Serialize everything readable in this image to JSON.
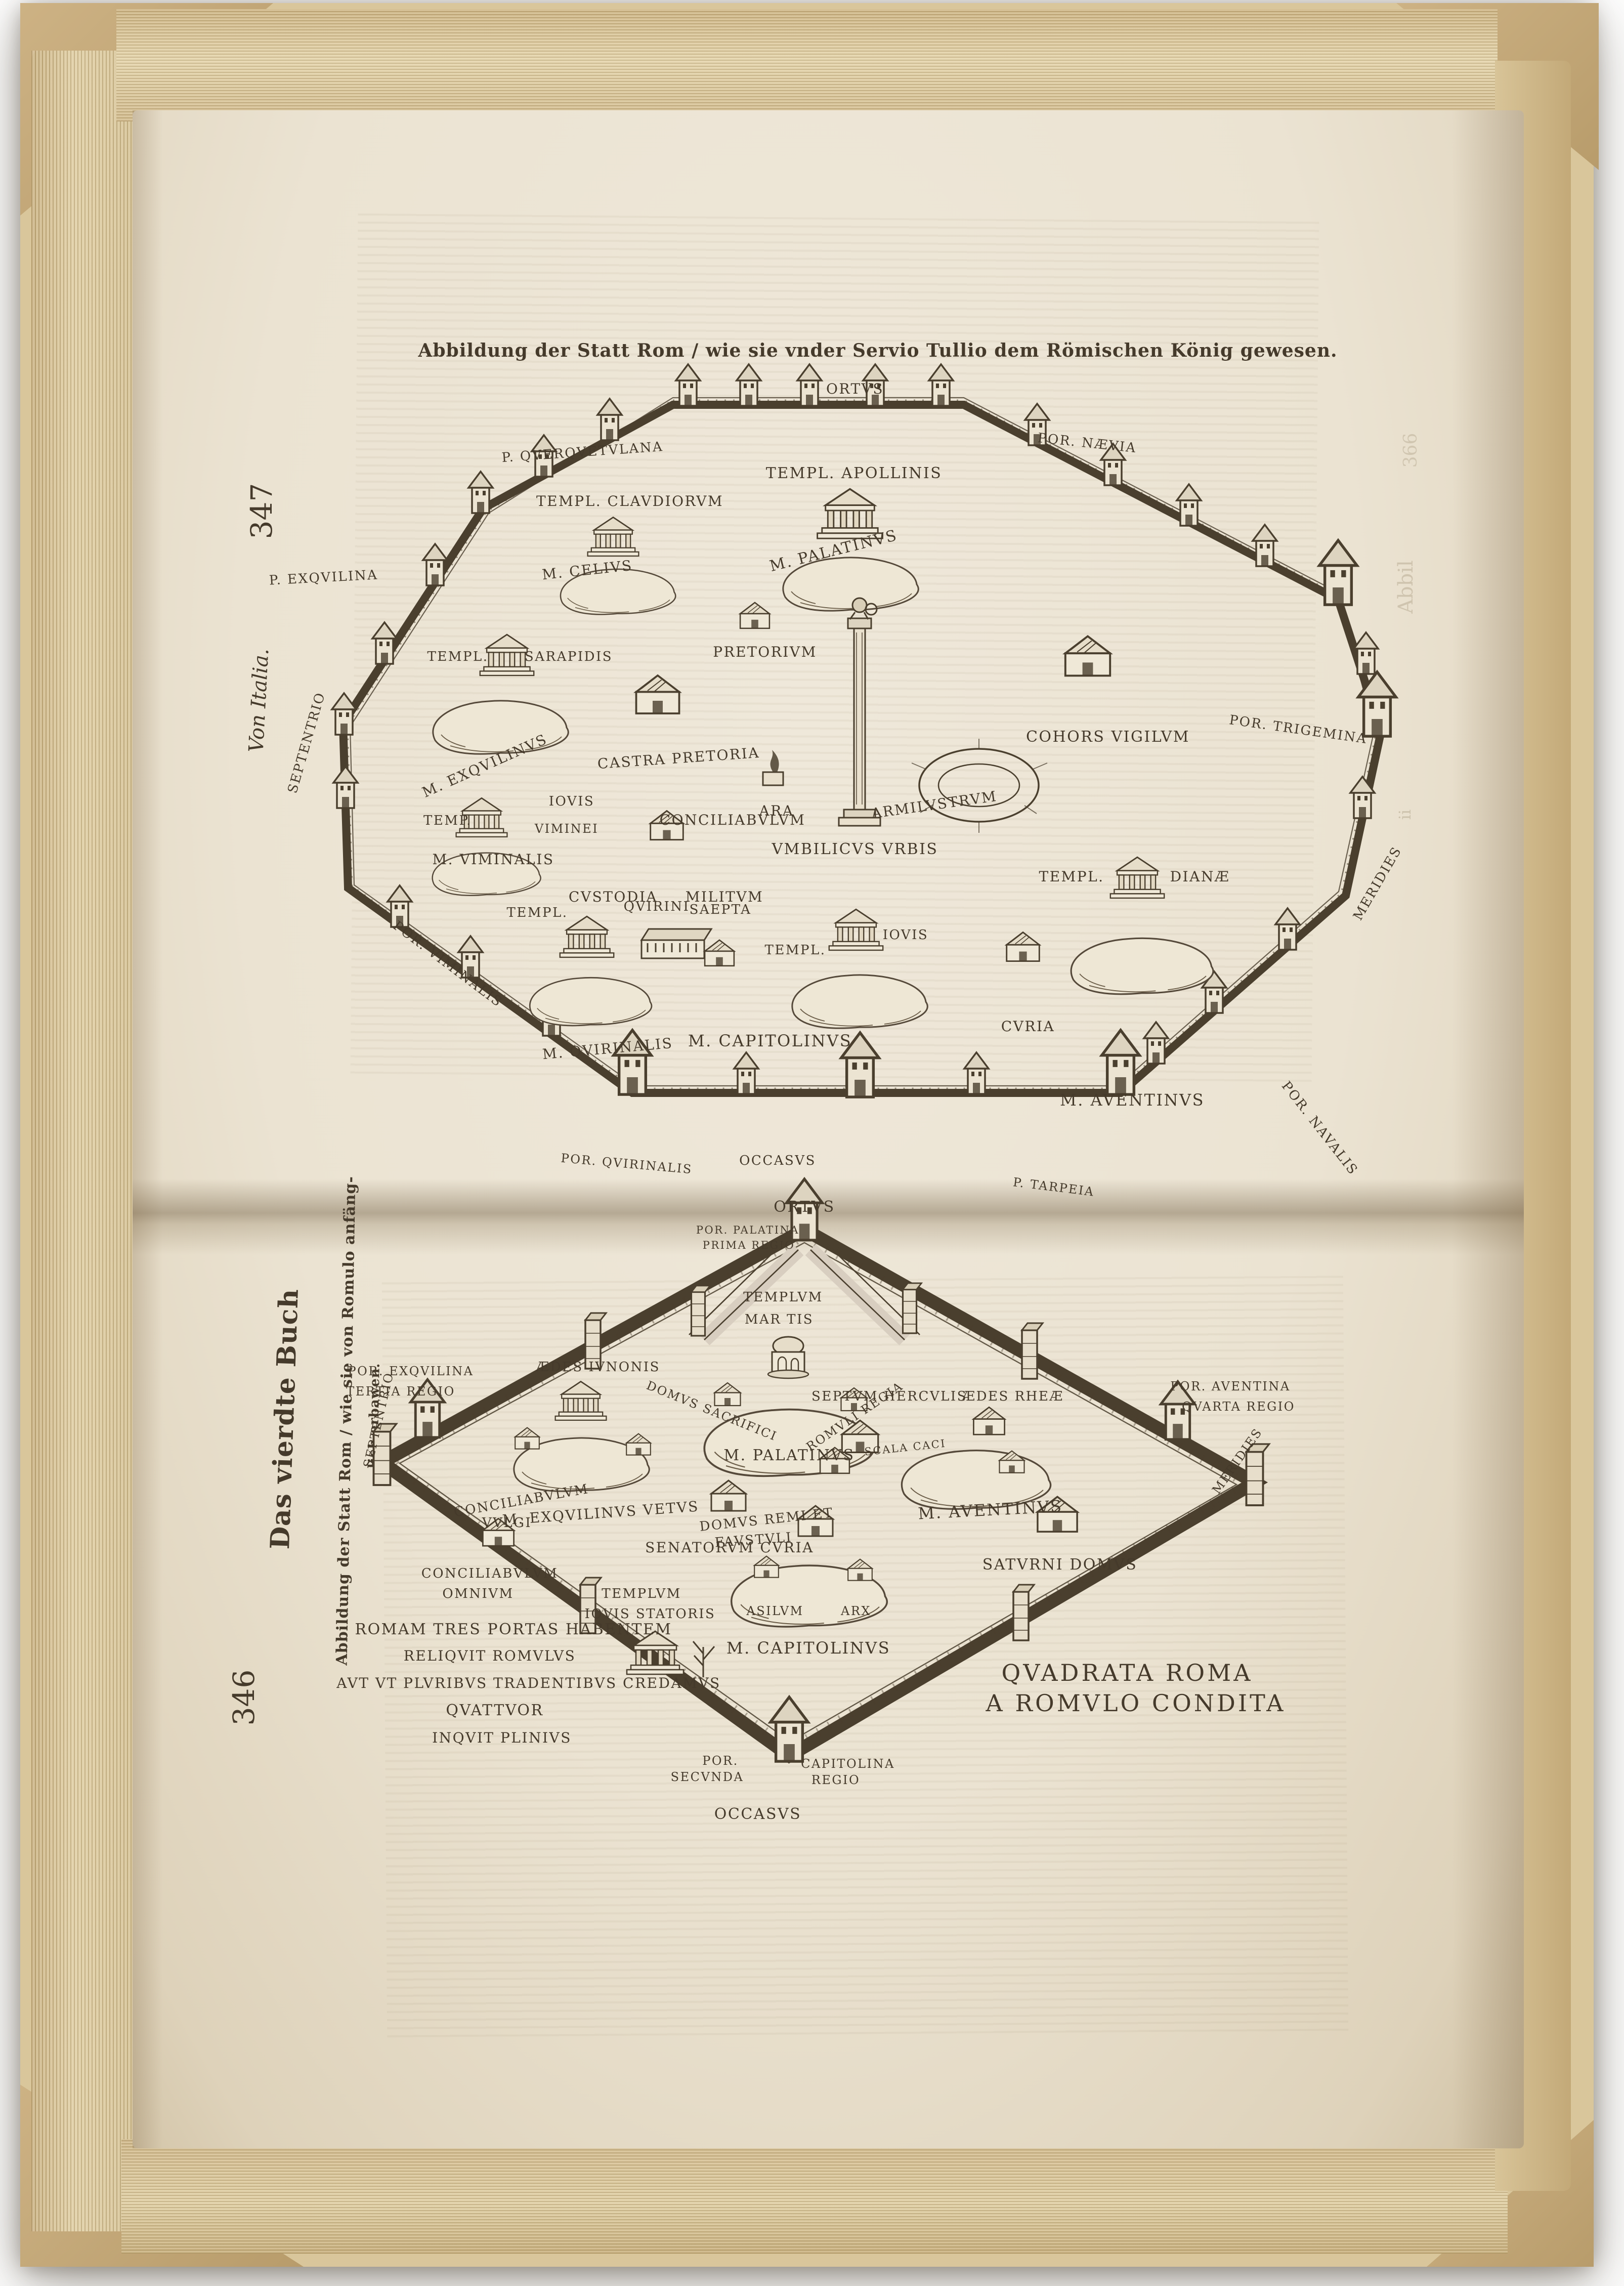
{
  "page_top": {
    "caption": "Abbildung der Statt Rom / wie sie vnder Servio Tullio dem Römischen König gewesen.",
    "page_number": "347",
    "margin_title": "Von Italia.",
    "compass": {
      "east": "ORTVS",
      "west": "OCCASVS",
      "north": "SEPTENTRIO",
      "south": "MERIDIES"
    },
    "gates": {
      "querquetulana": "P. QVERQVETVLANA",
      "naevia": "POR. NÆVIA",
      "trigemina": "POR. TRIGEMINA",
      "exquilina": "P. EXQVILINA",
      "viminalis": "POR. VIMINALIS",
      "quirinalis": "POR. QVIRINALIS",
      "tarpeia": "P. TARPEIA",
      "navalis": "POR. NAVALIS"
    },
    "labels": {
      "templ_apollinis": "TEMPL. APOLLINIS",
      "m_palatinus": "M. PALATINVS",
      "templ_claudiorum": "TEMPL. CLAVDIORVM",
      "m_celius": "M. CELIVS",
      "templ_sarapidis_1": "TEMPL.",
      "templ_sarapidis_2": "SARAPIDIS",
      "m_exquilinus": "M. EXQVILINVS",
      "castra_pretoria": "CASTRA PRETORIA",
      "pretorium": "PRETORIVM",
      "temp_iovis_1": "TEMP.",
      "temp_iovis_2": "IOVIS",
      "temp_iovis_3": "VIMINEI",
      "conciliabulum": "CONCILIABVLVM",
      "custodia": "CVSTODIA",
      "militum": "MILITVM",
      "ara": "ARA",
      "umbilicus": "VMBILICVS VRBIS",
      "armilustrum": "ARMILVSTRVM",
      "cohors_vigilum": "COHORS VIGILVM",
      "templ_dianae_1": "TEMPL.",
      "templ_dianae_2": "DIANÆ",
      "m_aventinus": "M. AVENTINVS",
      "m_viminalis": "M. VIMINALIS",
      "templ_quirini_1": "TEMPL.",
      "templ_quirini_2": "QVIRINI",
      "saepta": "SAEPTA",
      "templ_iovis_1": "TEMPL.",
      "templ_iovis_2": "IOVIS",
      "m_quirinalis": "M. QVIRINALIS",
      "m_capitolinus": "M. CAPITOLINVS",
      "curia": "CVRIA"
    },
    "artifacts": {
      "bleed_text": "Abbil",
      "bleed_sig": "ii",
      "bleed_num": "366"
    }
  },
  "page_bottom": {
    "page_number": "346",
    "margin_title": "Das vierdte Buch",
    "margin_caption_1": "Abbildung der Statt Rom / wie sie von Romulo anfäng-",
    "margin_caption_2": "lich erbawen.",
    "title_1": "QVADRATA ROMA",
    "title_2": "A ROMVLO CONDITA",
    "compass": {
      "east": "ORTVS",
      "west": "OCCASVS",
      "north": "SEPTENTRIO",
      "south": "MERIDIES"
    },
    "gates": {
      "palatina_1": "POR. PALATINA",
      "palatina_2": "PRIMA REGIO",
      "exquilina_1": "POR. EXQVILINA",
      "exquilina_2": "TERTIA REGIO",
      "aventina_1": "POR. AVENTINA",
      "aventina_2": "QVARTA REGIO",
      "secunda_1": "POR.",
      "secunda_2": "SECVNDA",
      "capitolina_1": "CAPITOLINA",
      "capitolina_2": "REGIO"
    },
    "labels": {
      "templum_martis_1": "TEMPLVM",
      "templum_martis_2": "MAR TIS",
      "domus_sacrifici": "DOMVS SACRIFICI",
      "romuli_regia": "ROMVLI REGIA",
      "m_palatinus": "M. PALATINVS",
      "aedes_iunonis": "ÆDES IVNONIS",
      "conciliabulum_vulgi_1": "CONCILIABVLVM",
      "conciliabulum_vulgi_2": "VVLGI",
      "m_exquilinus_vetus": "M. EXQVILINVS VETVS",
      "senatorum_curia": "SENATORVM CVRIA",
      "septum_herculis": "SEPTVM HERCVLIS",
      "aedes_rheae": "ÆDES RHEÆ",
      "scala_caci": "SCALA CACI",
      "domus_remi_1": "DOMVS REMI ET",
      "domus_remi_2": "FAVSTVLI",
      "m_aventinus": "M. AVENTINVS",
      "templum_iovis_1": "TEMPLVM",
      "templum_iovis_2": "IOVIS STATORIS",
      "conciliabulum_omnium_1": "CONCILIABVLVM",
      "conciliabulum_omnium_2": "OMNIVM",
      "asilum": "ASILVM",
      "arx": "ARX",
      "m_capitolinus": "M. CAPITOLINVS",
      "saturni_domus": "SATVRNI DOMVS"
    },
    "pliny": [
      "ROMAM TRES PORTAS HABENTEM",
      "RELIQVIT ROMVLVS",
      "AVT VT PLVRIBVS TRADENTIBVS CREDAMVS",
      "QVATTVOR",
      "INQVIT PLINIVS"
    ]
  }
}
